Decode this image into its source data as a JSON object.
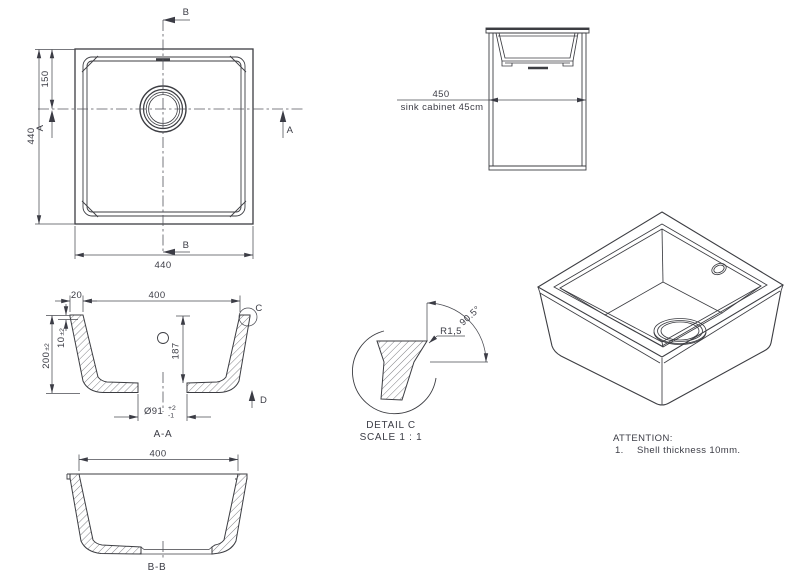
{
  "colors": {
    "line": "#3c3d42",
    "text": "#3b3c45"
  },
  "top_view": {
    "section_b_top": "B",
    "section_b_bottom": "B",
    "section_a_left": "A",
    "section_a_right": "A",
    "dim_150": "150",
    "dim_440_vertical": "440",
    "dim_440_horizontal": "440"
  },
  "cabinet_view": {
    "dim_450": "450",
    "label": "sink cabinet 45cm"
  },
  "section_aa": {
    "dim_20": "20",
    "dim_400": "400",
    "dim_10": "10",
    "dim_10_tol": "±2",
    "dim_200": "200",
    "dim_200_tol": "±2",
    "dim_187": "187",
    "dim_drain": "Ø91",
    "dim_drain_tol_upper": "+2",
    "dim_drain_tol_lower": "-1",
    "detail_label": "C",
    "direction_label": "D",
    "title": "A-A"
  },
  "detail_c": {
    "radius": "R1,5",
    "angle": "90.5°",
    "title": "DETAIL C",
    "scale": "SCALE 1 : 1"
  },
  "section_bb": {
    "dim_400": "400",
    "title": "B-B"
  },
  "attention": {
    "heading": "ATTENTION:",
    "item_number": "1.",
    "item_text": "Shell thickness 10mm."
  }
}
